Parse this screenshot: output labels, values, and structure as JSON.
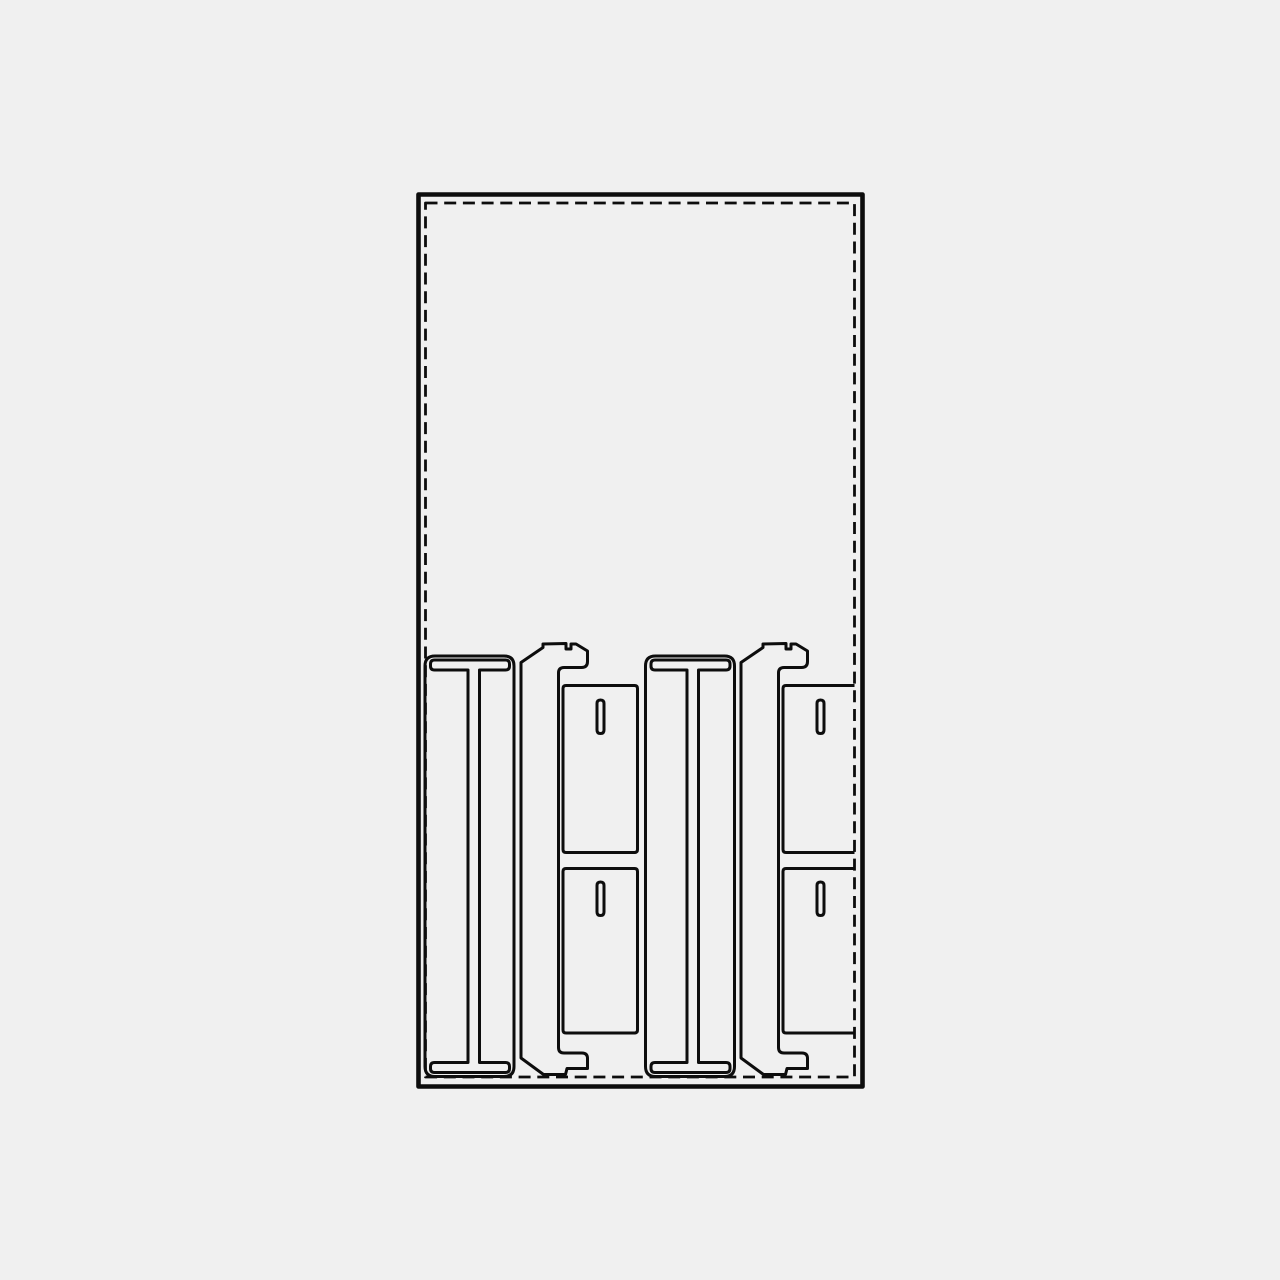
{
  "drawing": {
    "background": "#f0f0f0",
    "line_color": "#0d0d0d",
    "canvas": {
      "width": 1280,
      "height": 1280
    },
    "elements": [
      {
        "name": "sheet-outer-border",
        "stroke_width": 4.6,
        "d": "M418.5 194.5 H862.5 V1086.5 H418.5 Z"
      },
      {
        "name": "sheet-margin-dashed",
        "stroke_width": 2.8,
        "dash": "12 6.7",
        "d": "M425.5 203 H854.5 V1077 H425.5 Z"
      },
      {
        "name": "ibeam-panel-1-outline",
        "stroke_width": 3,
        "d": "M435 656 H504 Q514 656 514 666 V1066.5 Q514 1076.5 504 1076.5 H435 Q425 1076.5 425 1066.5 V666 Q425 656 435 656 Z"
      },
      {
        "name": "ibeam-panel-1-tslot",
        "stroke_width": 3,
        "d": "M434.5 660 H505.5 Q509.5 660 509.5 664 V666 Q509.5 670 505.5 670 H479.5 V1062.5 H505.5 Q509.5 1062.5 509.5 1066.5 V1068.5 Q509.5 1072.5 505.5 1072.5 H434.5 Q430.5 1072.5 430.5 1068.5 V1066.5 Q430.5 1062.5 434.5 1062.5 H468 V670 H434.5 Q430.5 670 430.5 666 V664 Q430.5 660 434.5 660 Z"
      },
      {
        "name": "hook-rail-1-outline",
        "stroke_width": 3,
        "d": "M521 662.5 L543 647.5 L543 644 L566 643.5 L566 649 L571 649 L571 644 L576 644 L587.5 651 V661.5 Q587.5 667.5 581.5 667.5 H564 Q558.5 667.5 558.5 673 V1047.5 Q558.5 1053 564 1053 H582 Q587.5 1053 587.5 1058.5 V1068.5 H567 L565.5 1074.5 H543.5 L521 1058 Z"
      },
      {
        "name": "shelf-panel-1a-outline",
        "stroke_width": 3,
        "d": "M566 685.5 H634.5 Q637.5 685.5 637.5 688.5 V849.5 Q637.5 852.5 634.5 852.5 H566 Q563 852.5 563 849.5 V688.5 Q563 685.5 566 685.5 Z"
      },
      {
        "name": "shelf-panel-1a-slot",
        "stroke_width": 3,
        "d": "M597 703.5 Q597 700 600.5 700 Q604 700 604 703.5 V730 Q604 733.5 600.5 733.5 Q597 733.5 597 730 Z"
      },
      {
        "name": "shelf-panel-1b-outline",
        "stroke_width": 3,
        "d": "M566 868.5 H634.5 Q637.5 868.5 637.5 871.5 V1030 Q637.5 1033 634.5 1033 H566 Q563 1033 563 1030 V871.5 Q563 868.5 566 868.5 Z"
      },
      {
        "name": "shelf-panel-1b-slot",
        "stroke_width": 3,
        "d": "M597 885.5 Q597 882 600.5 882 Q604 882 604 885.5 V912 Q604 915.5 600.5 915.5 Q597 915.5 597 912 Z"
      },
      {
        "name": "ibeam-panel-2-outline",
        "stroke_width": 3,
        "d": "M655.5 656 H724.5 Q734.5 656 734.5 666 V1066.5 Q734.5 1076.5 724.5 1076.5 H655.5 Q645.5 1076.5 645.5 1066.5 V666 Q645.5 656 655.5 656 Z"
      },
      {
        "name": "ibeam-panel-2-tslot",
        "stroke_width": 3,
        "d": "M655 660 H726 Q730 660 730 664 V666 Q730 670 726 670 H698.5 V1062.5 H726 Q730 1062.5 730 1066.5 V1068.5 Q730 1072.5 726 1072.5 H655 Q651 1072.5 651 1068.5 V1066.5 Q651 1062.5 655 1062.5 H687 V670 H655 Q651 670 651 666 V664 Q651 660 655 660 Z"
      },
      {
        "name": "hook-rail-2-outline",
        "stroke_width": 3,
        "d": "M741 662.5 L763 647.5 L763 644 L786 643.5 L786 649 L791 649 L791 644 L796 644 L807.5 651 V661.5 Q807.5 667.5 801.5 667.5 H784 Q778.5 667.5 778.5 673 V1047.5 Q778.5 1053 784 1053 H802 Q807.5 1053 807.5 1058.5 V1068.5 H787 L785.5 1074.5 H763.5 L741 1058 Z"
      },
      {
        "name": "shelf-panel-2a-outline",
        "stroke_width": 3,
        "d": "M854.5 685.5 H786 Q783 685.5 783 688.5 V849.5 Q783 852.5 786 852.5 H854.5"
      },
      {
        "name": "shelf-panel-2a-slot",
        "stroke_width": 3,
        "d": "M817 703.5 Q817 700 820.5 700 Q824 700 824 703.5 V730 Q824 733.5 820.5 733.5 Q817 733.5 817 730 Z"
      },
      {
        "name": "shelf-panel-2b-outline",
        "stroke_width": 3,
        "d": "M854.5 868.5 H786 Q783 868.5 783 871.5 V1030 Q783 1033 786 1033 H854.5"
      },
      {
        "name": "shelf-panel-2b-slot",
        "stroke_width": 3,
        "d": "M817 885.5 Q817 882 820.5 882 Q824 882 824 885.5 V912 Q824 915.5 820.5 915.5 Q817 915.5 817 912 Z"
      }
    ]
  }
}
